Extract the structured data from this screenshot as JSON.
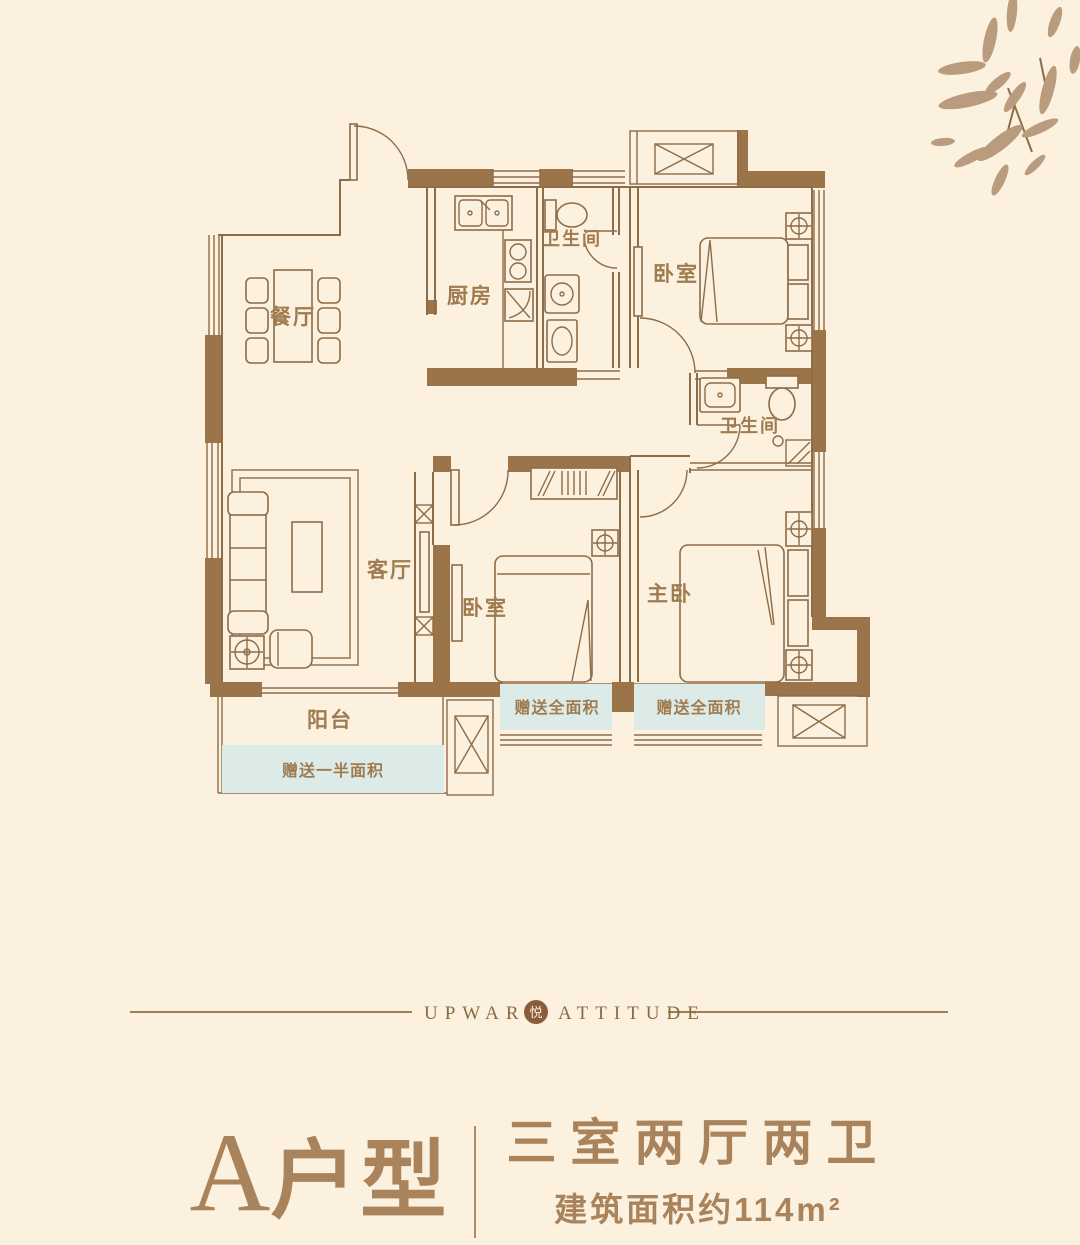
{
  "plan": {
    "rooms": {
      "dining": "餐厅",
      "kitchen": "厨房",
      "bath1": "卫生间",
      "bedroom1": "卧室",
      "bath2": "卫生间",
      "living": "客厅",
      "bedroom2": "卧室",
      "master": "主卧",
      "balcony": "阳台"
    },
    "gifts": {
      "half": "赠送一半面积",
      "full1": "赠送全面积",
      "full2": "赠送全面积"
    }
  },
  "brand": {
    "left": "UPWARD",
    "seal": "悦",
    "right": "ATTITUDE"
  },
  "footer": {
    "unit_letter": "A",
    "unit_type": "户型",
    "layout": "三室两厅两卫",
    "area": "建筑面积约114m²"
  },
  "colors": {
    "background": "#fcf1de",
    "wall": "#9b744a",
    "line": "#8d6c48",
    "label": "#9f7b50",
    "gift_area": "#dcebe7",
    "accent": "#a8835c",
    "bamboo": "#b89c7d"
  }
}
